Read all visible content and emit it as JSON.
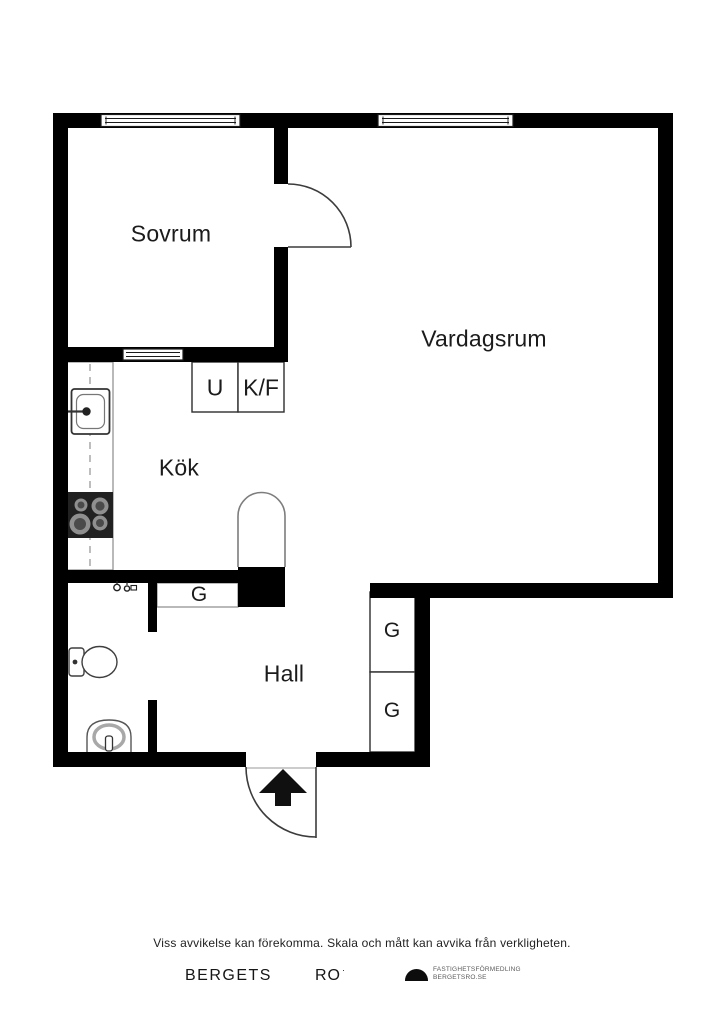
{
  "plan": {
    "rooms": [
      {
        "id": "sovrum",
        "label": "Sovrum"
      },
      {
        "id": "vardagsrum",
        "label": "Vardagsrum"
      },
      {
        "id": "kok",
        "label": "Kök"
      },
      {
        "id": "hall",
        "label": "Hall"
      }
    ],
    "closets": [
      {
        "id": "u",
        "label": "U"
      },
      {
        "id": "kf",
        "label": "K/F"
      },
      {
        "id": "g-kitchen",
        "label": "G"
      },
      {
        "id": "g-hall-upper",
        "label": "G"
      },
      {
        "id": "g-hall-lower",
        "label": "G"
      }
    ],
    "colors": {
      "wall": "#000000",
      "line": "#3f3f3f",
      "stove": "#212121"
    }
  },
  "footer": {
    "disclaimer": "Viss avvikelse kan förekomma. Skala och mått kan avvika från verkligheten.",
    "brand_left": "BERGETS",
    "brand_right": "RO",
    "brand_mark": "·",
    "agency_line1": "FASTIGHETSFÖRMEDLING",
    "agency_line2": "BERGETSRO.SE"
  }
}
